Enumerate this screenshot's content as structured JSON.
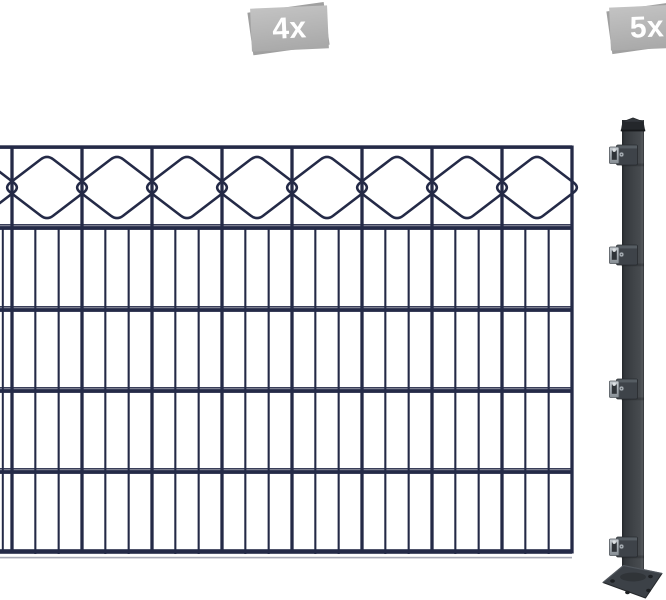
{
  "image": {
    "background": "#ffffff",
    "badges": [
      {
        "label": "4x"
      },
      {
        "label": "5x"
      }
    ],
    "fence": {
      "color": "#242a47"
    },
    "post": {
      "body_color": "#3f4347",
      "cap_color": "#24272b",
      "bracket_metal_color": "#aab0b6",
      "base_plate_color": "#3c4147"
    },
    "badge_style": {
      "back_color": "#a0a0a0",
      "front_color": "#b4b4b4",
      "text_color": "#ffffff"
    }
  }
}
